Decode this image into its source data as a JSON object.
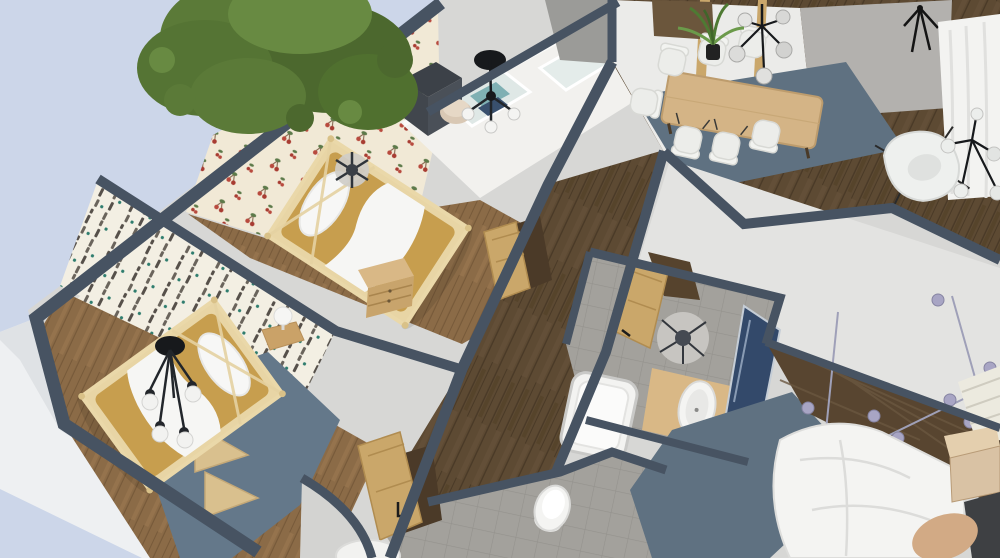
{
  "app": {
    "view_label": "3D aerial dollhouse floor plan render",
    "camera": "high oblique view from south-west"
  },
  "palette": {
    "sky": "#ccd6e9",
    "wall_top_band": "#475362",
    "wall_base_gray": "#d7d7d5",
    "wall_white_face": "#eef0f2",
    "wall_soft_white": "#ebebe9",
    "wall_mid_gray": "#9b9b98",
    "wall_far_gray": "#b3b1ae",
    "wood_floor_dark": "#5d4a33",
    "wood_floor_light": "#8b6b47",
    "light_wood": "#caa76b",
    "frame_wood": "#e8d5a5",
    "vanity_wood": "#d9b886",
    "mattress_tan": "#c79e4e",
    "rug_blue_gray": "#5f7181",
    "rug_blue_gray2": "#64788a",
    "tile_gray": "#a3a19c",
    "tree_green": "#5b7a38",
    "tree_green_dark": "#4c682e",
    "tree_green_light": "#688a42",
    "accent_wood_wall": "#584530",
    "mirror_navy": "#33496a",
    "white_furniture": "#f4f4f2",
    "black_fixture": "#17191c",
    "bulb_lavender": "#a8a5c4",
    "pouf_beige": "#d9c8b4",
    "wardrobe_gray": "#4a5058",
    "nightstand_beige": "#d9c2a4",
    "pillow_tan": "#d2aa85",
    "slab_dark": "#3e4043",
    "cherry_bg": "#f1e9d6",
    "birch_bg": "#f3efe3"
  },
  "scene": {
    "environment": {
      "sky": "pale blue sky",
      "tree": "large green tree outside top-left corner"
    },
    "rooms": [
      {
        "name": "kids-bedroom-cherry",
        "wallpaper": "cherry print wallpaper",
        "furniture": [
          "wooden canopy bed with tan bedding",
          "white pillow and blanket",
          "dark gray wardrobe",
          "beige pouf",
          "black chandelier",
          "gray ceiling fan light",
          "window wall with white frames"
        ]
      },
      {
        "name": "kids-bedroom-birch",
        "wallpaper": "birch tree print wallpaper",
        "furniture": [
          "wooden canopy bed with tan bedding",
          "black chandelier with white globe bulbs",
          "blue-gray rug",
          "light wood corner shelves",
          "white table lamp on wooden nightstand"
        ]
      },
      {
        "name": "hallway",
        "floor": "dark wood planks",
        "furniture": [
          "wooden doors ajar",
          "wooden dresser",
          "built-in closet"
        ]
      },
      {
        "name": "living-dining",
        "floor": "dark wood planks",
        "furniture": [
          "wooden dining table",
          "white dining chairs",
          "blue-gray rug",
          "black multi-globe pendant lamp",
          "potted palm plant",
          "white curtains",
          "white egg armchair",
          "black globe chandelier",
          "black coat stand",
          "wooden sideboard"
        ]
      },
      {
        "name": "bathroom",
        "floor": "gray tile",
        "furniture": [
          "white bathtub",
          "oval white sink on wooden vanity",
          "leaning navy mirror",
          "gray ceiling lamp",
          "wooden door ajar"
        ]
      },
      {
        "name": "wc",
        "floor": "gray tile",
        "furniture": [
          "white toilet",
          "wooden door ajar",
          "round white table",
          "curved wall"
        ]
      },
      {
        "name": "master-bedroom",
        "furniture": [
          "white duvet bed",
          "dark wood accent headboard wall",
          "string wall lights with lavender shades",
          "beige nightstand",
          "tan pillow",
          "dark gray dresser",
          "blue-gray rug",
          "cream textured rug"
        ]
      }
    ]
  }
}
